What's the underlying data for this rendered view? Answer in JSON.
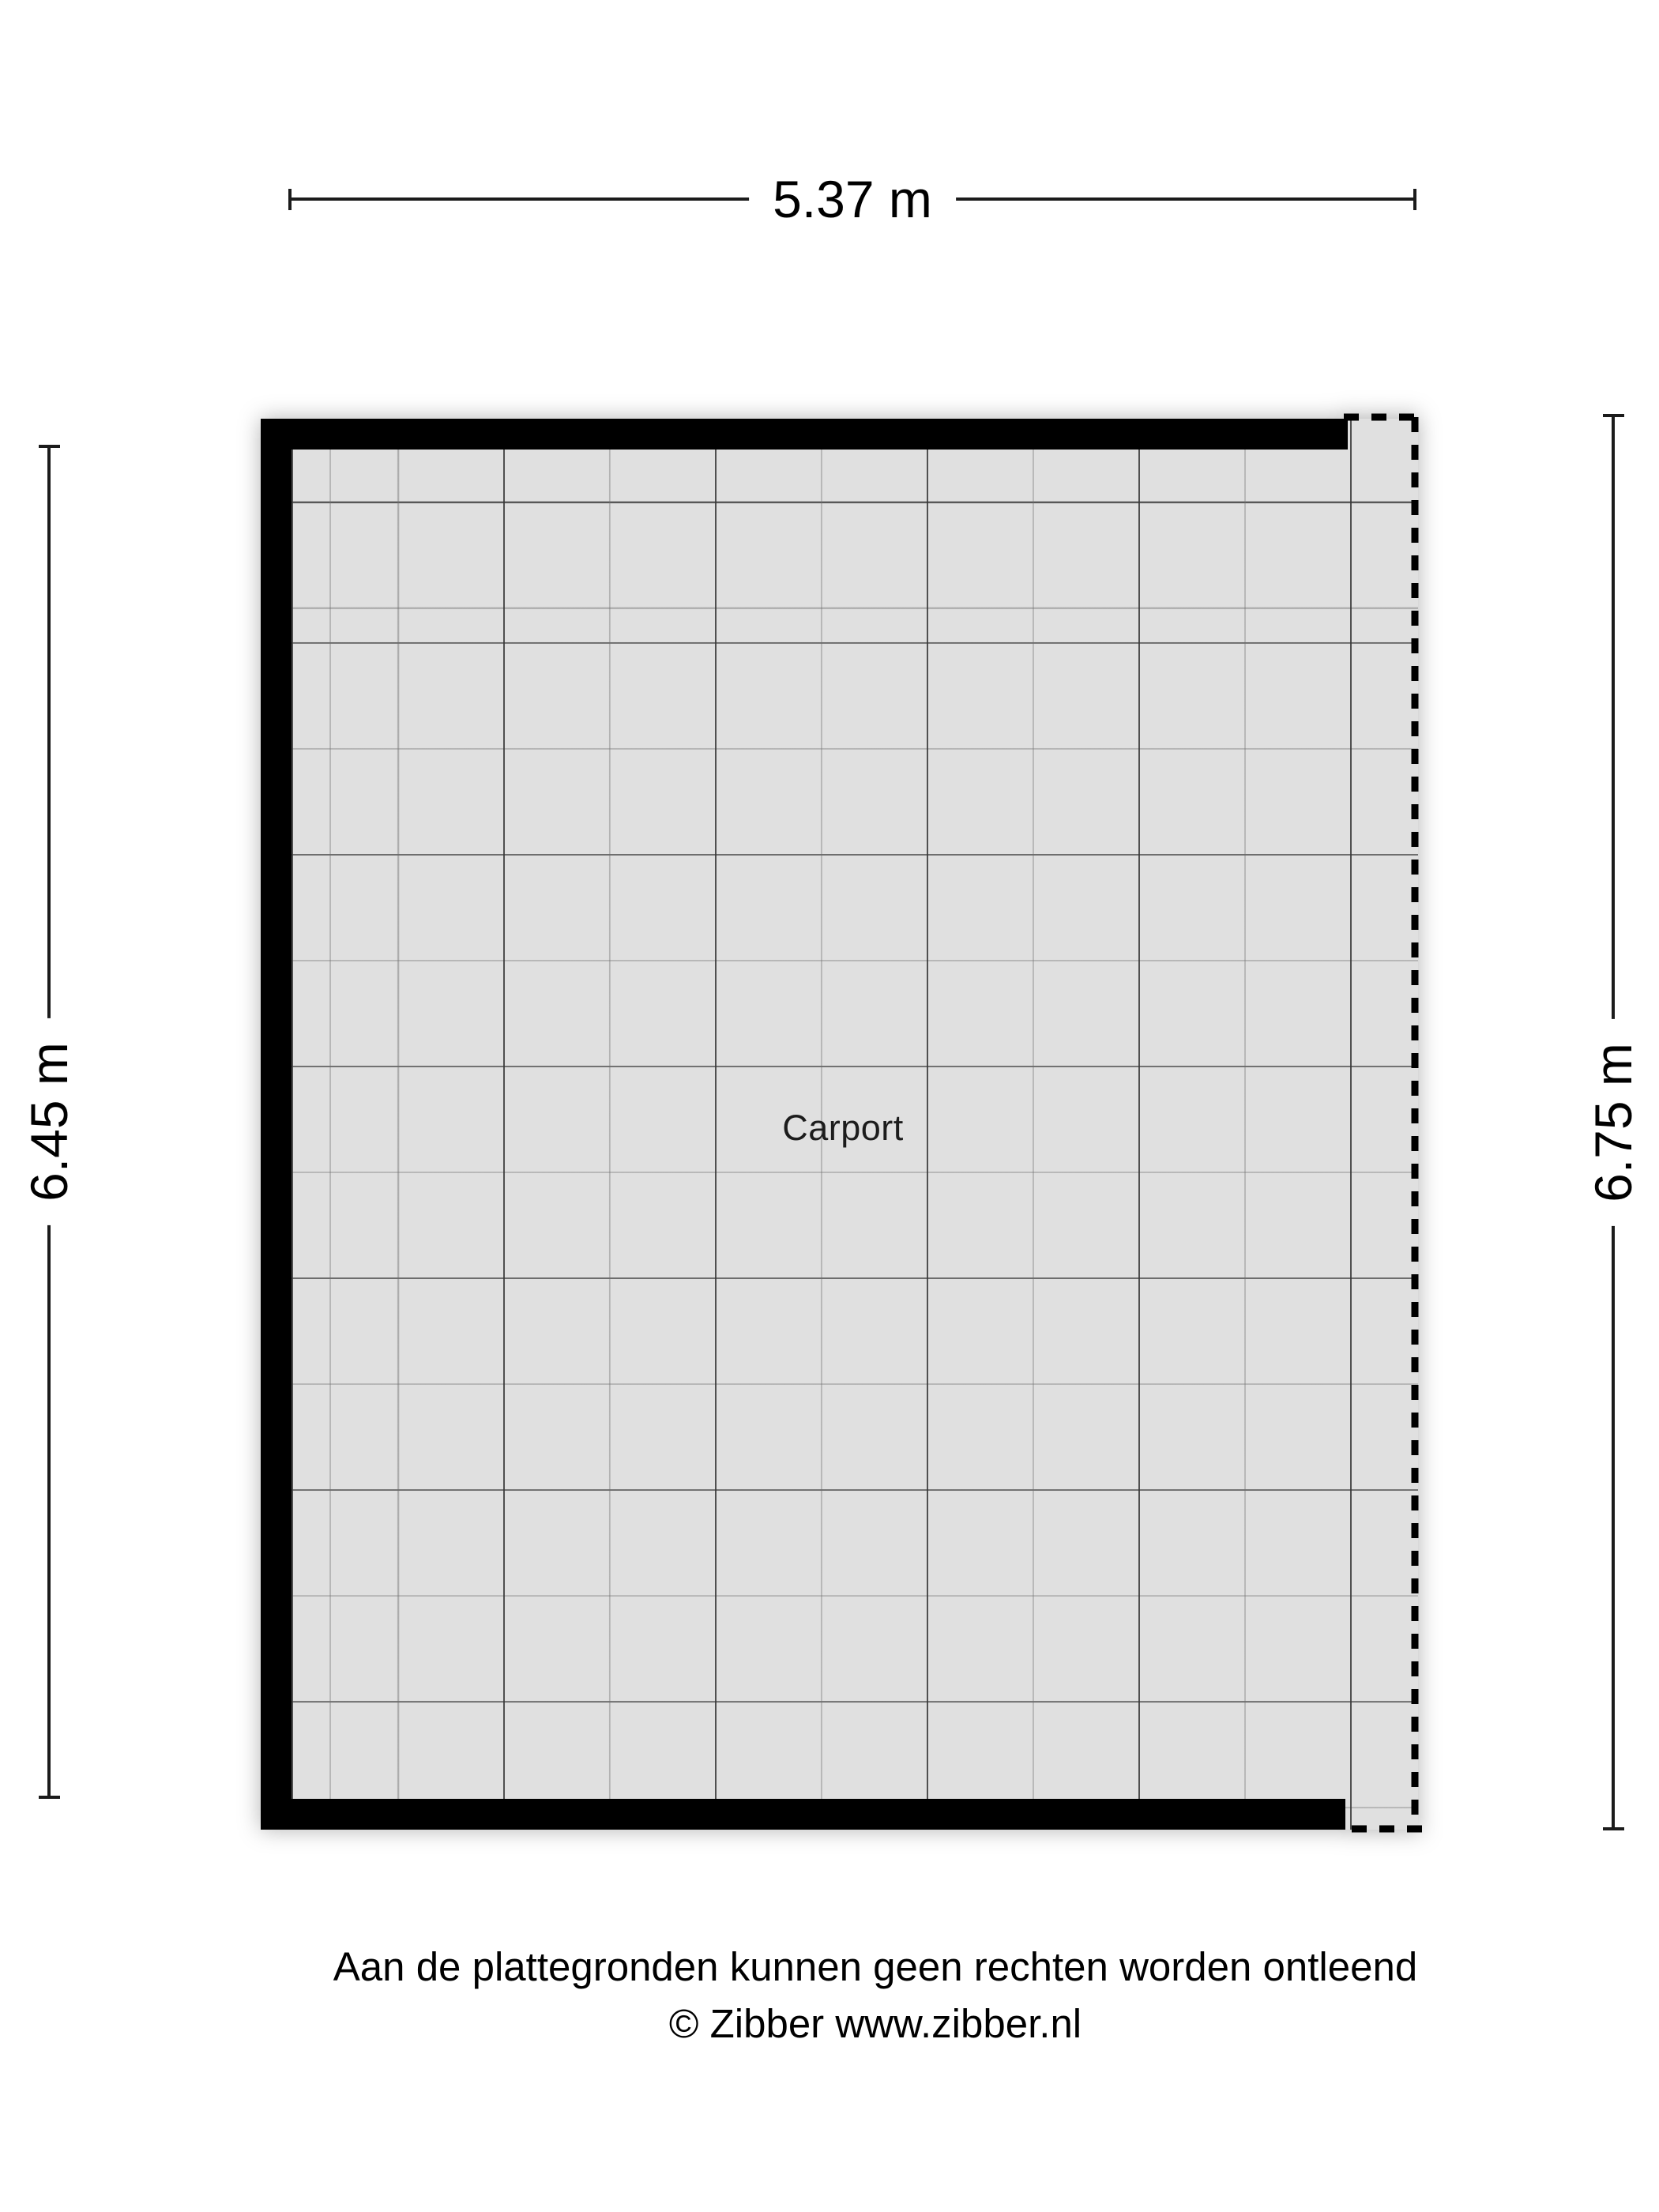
{
  "floorplan": {
    "room_label": "Carport"
  },
  "dimensions": {
    "top": "5.37 m",
    "left": "6.45 m",
    "right": "6.75 m"
  },
  "footer": {
    "disclaimer": "Aan de plattegronden kunnen geen rechten worden ontleend",
    "copyright": "© Zibber www.zibber.nl"
  },
  "colors": {
    "wall": "#000000",
    "floor": "#e0e0e0",
    "grid_major": "#373737",
    "grid_minor": "#6e6e6e",
    "background": "#ffffff"
  }
}
